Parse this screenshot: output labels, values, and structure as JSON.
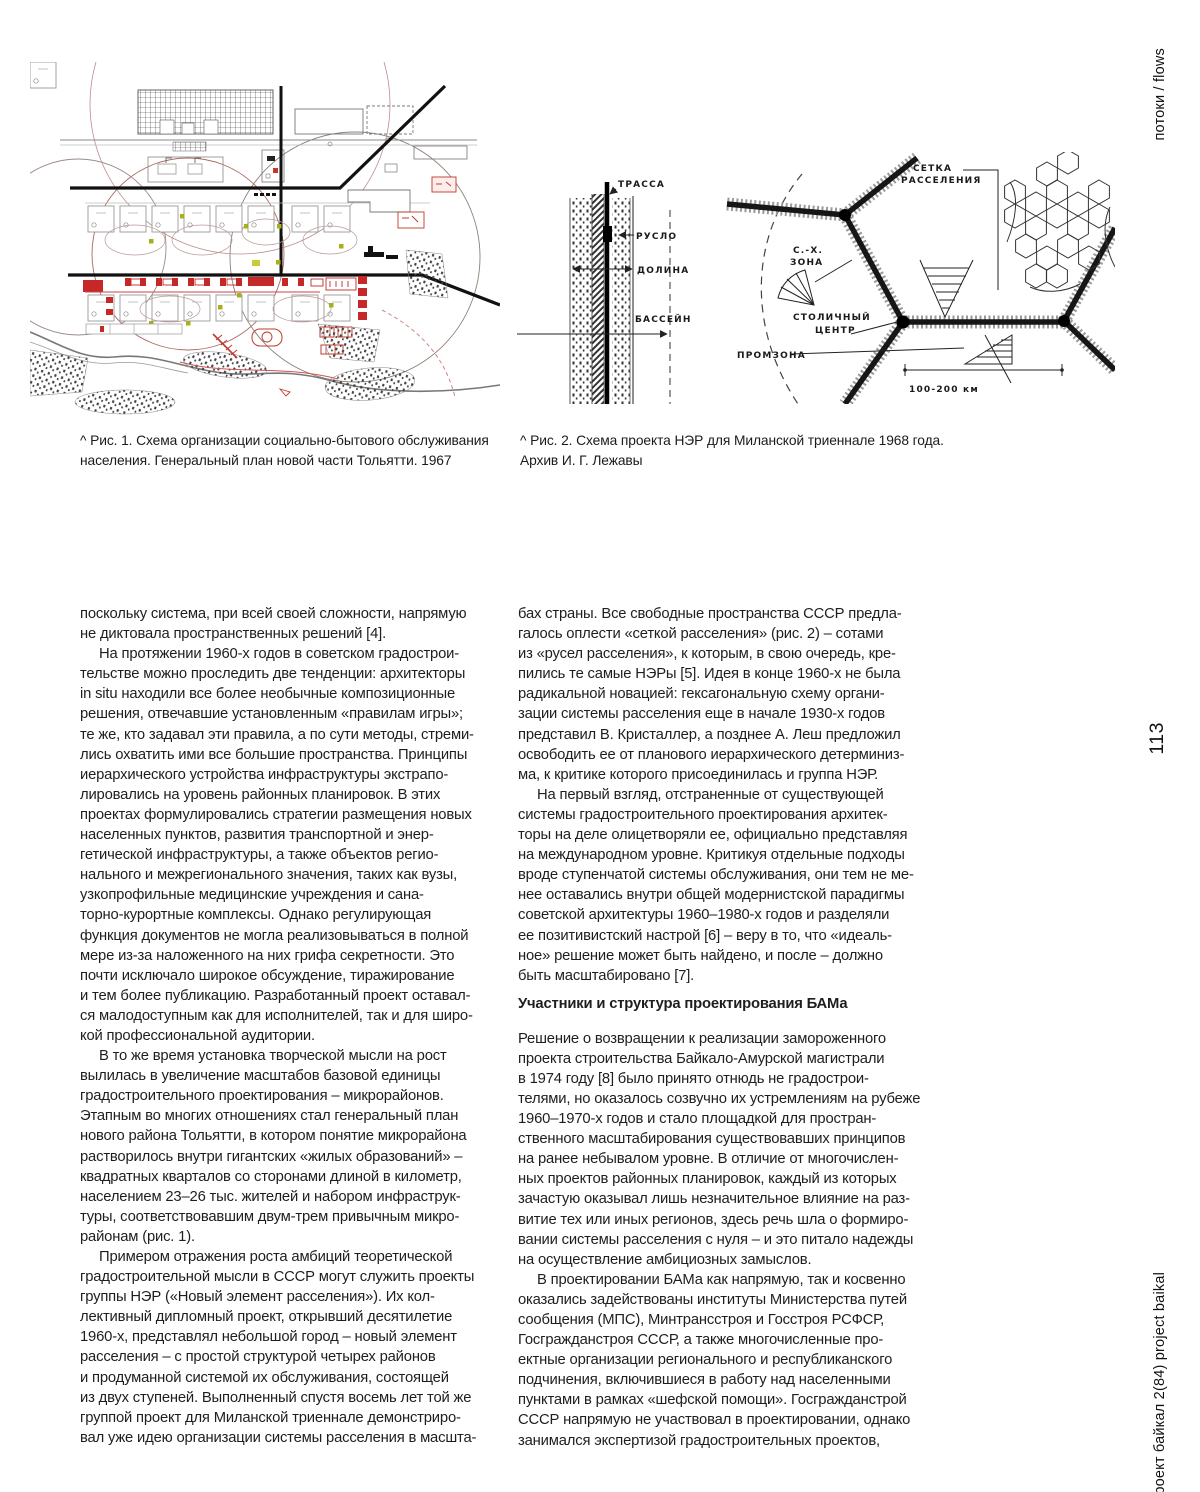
{
  "margins": {
    "top_right": "потоки / flows",
    "page_number": "113",
    "bottom_right": "проект байкал 2(84) project baikal"
  },
  "captions": {
    "fig1": [
      "^  Рис. 1. Схема организации социально-бытового обслуживания",
      "населения. Генеральный план новой части Тольятти. 1967"
    ],
    "fig2": [
      "^  Рис. 2. Схема проекта НЭР для Миланской триеннале 1968 года.",
      "Архив И. Г. Лежавы"
    ]
  },
  "fig2_labels": {
    "trassa": "ТРАССА",
    "ruslo": "РУСЛО",
    "dolina": "ДОЛИНА",
    "bassein": "БАССЕЙН",
    "setka_1": "СЕТКА",
    "setka_2": "РАССЕЛЕНИЯ",
    "sh_zona_1": "С.-Х.",
    "sh_zona_2": "ЗОНА",
    "capital_1": "СТОЛИЧНЫЙ",
    "capital_2": "ЦЕНТР",
    "promzona": "ПРОМЗОНА",
    "scale": "100-200 км"
  },
  "columns": {
    "left": {
      "p0": [
        "поскольку система, при всей своей сложности, напрямую",
        "не диктовала пространственных решений [4]."
      ],
      "p1": [
        "На протяжении 1960-х годов в советском градострои-",
        "тельстве можно проследить две тенденции: архитекторы",
        "in situ находили все более необычные композиционные",
        "решения, отвечавшие установленным «правилам игры»;",
        "те же, кто задавал эти правила, а по сути методы, стреми-",
        "лись охватить ими все большие пространства. Принципы",
        "иерархического устройства инфраструктуры экстрапо-",
        "лировались на уровень районных планировок. В этих",
        "проектах формулировались стратегии размещения новых",
        "населенных пунктов, развития транспортной и энер-",
        "гетической инфраструктуры, а также объектов регио-",
        "нального и межрегионального значения, таких как вузы,",
        "узкопрофильные медицинские учреждения и сана-",
        "торно-курортные комплексы. Однако регулирующая",
        "функция документов не могла реализовываться в полной",
        "мере из-за наложенного на них грифа секретности. Это",
        "почти исключало широкое обсуждение, тиражирование",
        "и тем более публикацию. Разработанный проект оставал-",
        "ся малодоступным как для исполнителей, так и для широ-",
        "кой профессиональной аудитории."
      ],
      "p2": [
        "В то же время установка творческой мысли на рост",
        "вылилась в увеличение масштабов базовой единицы",
        "градостроительного проектирования – микрорайонов.",
        "Этапным во многих отношениях стал генеральный план",
        "нового района Тольятти, в котором понятие микрорайона",
        "растворилось внутри гигантских «жилых образований» –",
        "квадратных кварталов со сторонами длиной в километр,",
        "населением 23–26 тыс. жителей и набором инфраструк-",
        "туры, соответствовавшим двум-трем привычным микро-",
        "районам (рис. 1)."
      ],
      "p3": [
        "Примером отражения роста амбиций теоретической",
        "градостроительной мысли в СССР могут служить проекты",
        "группы НЭР («Новый элемент расселения»). Их кол-",
        "лективный дипломный проект, открывший десятилетие",
        "1960-х, представлял небольшой город – новый элемент",
        "расселения – с простой структурой четырех районов",
        "и продуманной системой их обслуживания, состоящей",
        "из двух ступеней. Выполненный спустя восемь лет той же",
        "группой проект для Миланской триеннале демонстриро-",
        "вал уже идею организации системы расселения в масшта-"
      ]
    },
    "right": {
      "p0": [
        "бах страны. Все свободные пространства СССР предла-",
        "галось оплести «сеткой расселения» (рис. 2) – сотами",
        "из «русел расселения», к которым, в свою очередь, кре-",
        "пились те самые НЭРы [5]. Идея в конце 1960-х не была",
        "радикальной новацией: гексагональную схему органи-",
        "зации системы расселения еще в начале 1930-х годов",
        "представил В. Кристаллер, а позднее А. Леш предложил",
        "освободить ее от планового иерархического детерминиз-",
        "ма, к критике которого присоединилась и группа НЭР."
      ],
      "p1": [
        "На первый взгляд, отстраненные от существующей",
        "системы градостроительного проектирования архитек-",
        "торы на деле олицетворяли ее, официально представляя",
        "на международном уровне. Критикуя отдельные подходы",
        "вроде ступенчатой системы обслуживания, они тем не ме-",
        "нее оставались внутри общей модернистской парадигмы",
        "советской архитектуры 1960–1980-х годов и разделяли",
        "ее позитивистский настрой [6] – веру в то, что «идеаль-",
        "ное» решение может быть найдено, и после – должно",
        "быть масштабировано [7]."
      ],
      "heading": "Участники и структура проектирования БАМа",
      "p2": [
        "Решение о возвращении к реализации замороженного",
        "проекта строительства Байкало-Амурской магистрали",
        "в 1974 году [8] было принято отнюдь не градострои-",
        "телями, но оказалось созвучно их устремлениям на рубеже",
        "1960–1970-х годов и стало площадкой для простран-",
        "ственного масштабирования существовавших принципов",
        "на ранее небывалом уровне. В отличие от многочислен-",
        "ных проектов районных планировок, каждый из которых",
        "зачастую оказывал лишь незначительное влияние на раз-",
        "витие тех или иных регионов, здесь речь шла о формиро-",
        "вании системы расселения с нуля – и это питало надежды",
        "на осуществление амбициозных замыслов."
      ],
      "p3": [
        "В проектировании БАМа как напрямую, так и косвенно",
        "оказались задействованы институты Министерства путей",
        "сообщения (МПС), Минтрансстроя и Госстроя РСФСР,",
        "Госгражданстроя СССР, а также многочисленные про-",
        "ектные организации регионального и республиканского",
        "подчинения, включившиеся в работу над населенными",
        "пунктами в рамках «шефской помощи». Госгражданстрой",
        "СССР напрямую не участвовал в проектировании, однако",
        "занимался экспертизой градостроительных проектов,"
      ]
    }
  }
}
